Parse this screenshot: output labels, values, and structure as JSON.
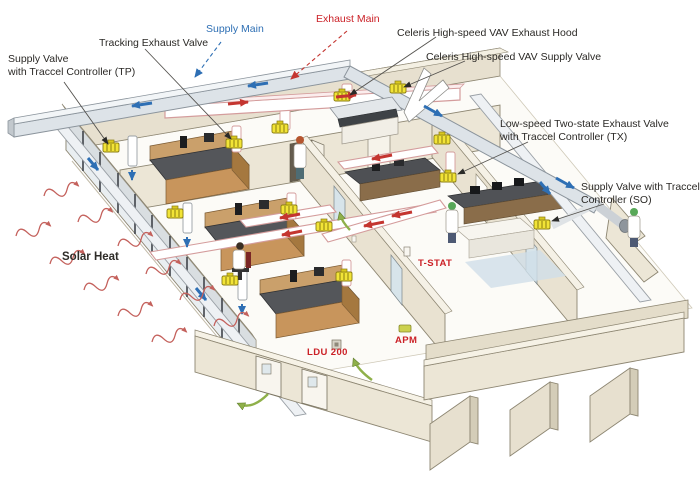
{
  "diagram": {
    "kind": "isometric laboratory HVAC airflow cutaway",
    "labels": {
      "supply_valve_tp": {
        "line1": "Supply Valve",
        "line2": "with Traccel Controller (TP)"
      },
      "tracking_exhaust_valve": {
        "text": "Tracking Exhaust Valve"
      },
      "supply_main": {
        "text": "Supply Main"
      },
      "exhaust_main": {
        "text": "Exhaust Main"
      },
      "celeris_exhaust_hood": {
        "text": "Celeris High-speed VAV Exhaust Hood"
      },
      "celeris_supply_valve": {
        "text": "Celeris High-speed VAV Supply Valve"
      },
      "low_speed_exhaust_tx": {
        "line1": "Low-speed Two-state Exhaust Valve",
        "line2": "with Traccel Controller (TX)"
      },
      "supply_valve_so": {
        "line1": "Supply Valve with Traccel",
        "line2": "Controller (SO)"
      },
      "solar_heat": {
        "text": "Solar Heat"
      },
      "t_stat": {
        "text": "T-STAT"
      },
      "ldu_200": {
        "text": "LDU 200"
      },
      "apm": {
        "text": "APM"
      }
    },
    "icons": {
      "supply_flow": "blue-arrow",
      "exhaust_flow": "red-arrow",
      "door_airflow": "green-curved-arrow",
      "solar_heat_wave": "red-wavy-arrow",
      "vav_valve": "yellow-valve-block"
    },
    "colors": {
      "supply_blue": "#2e6fb4",
      "exhaust_red": "#cb2127",
      "exhaust_duct_outline": "#d49c9c",
      "valve_yellow": "#f2e437",
      "airflow_green": "#8fb04a",
      "wall_cream": "#ebe4d3",
      "bench_wood": "#c8955c",
      "bench_top_gray": "#54565a",
      "duct_gray": "#dde3e8",
      "label_text": "#2b2926"
    }
  }
}
